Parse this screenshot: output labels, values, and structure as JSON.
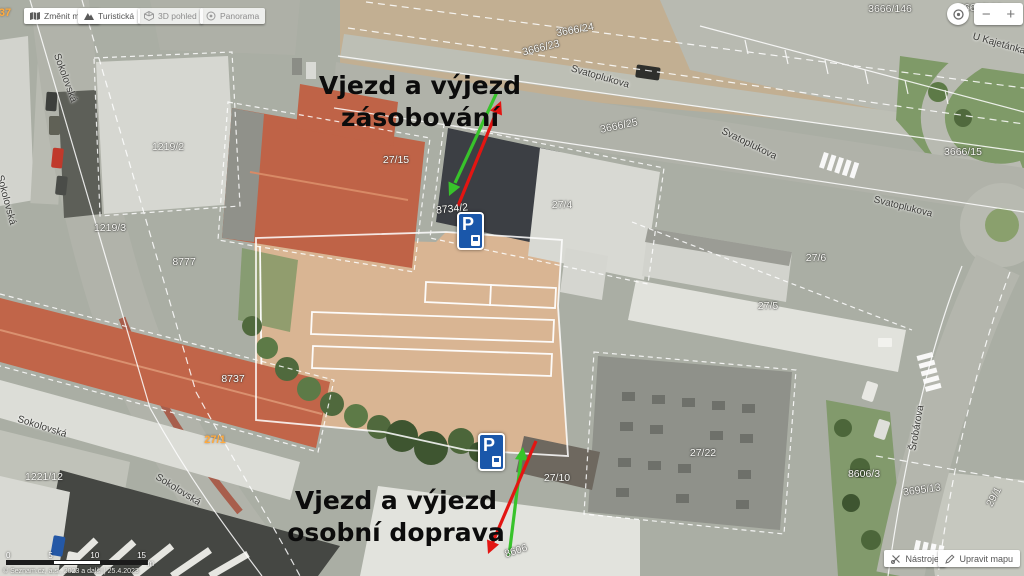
{
  "app": {
    "toolbar": [
      {
        "label": "Změnit mapu"
      },
      {
        "label": "Turistická"
      },
      {
        "label": "3D pohled"
      },
      {
        "label": "Panorama"
      }
    ],
    "map_controls": {
      "zoom_out": "−",
      "zoom_in": "+"
    },
    "footer_tools": [
      {
        "label": "Nástroje"
      },
      {
        "label": "Upravit mapu"
      }
    ],
    "scale_bar": {
      "ticks": [
        "0",
        "5",
        "10",
        "15"
      ],
      "unit": "m"
    },
    "attribution": "© Seznam.cz, a.s., 2023 a další | 25.4.2023"
  },
  "annotations": {
    "supply": {
      "line1": "Vjezd a výjezd",
      "line2": "zásobování"
    },
    "personal": {
      "line1": "Vjezd a výjezd",
      "line2": "osobní doprava"
    },
    "arrow_green": "#38c32b",
    "arrow_red": "#e31512"
  },
  "map": {
    "parking_sign": {
      "letter": "P"
    },
    "labels": [
      {
        "t": "3666/24",
        "x": 575,
        "y": 30,
        "r": -10,
        "c": "parcel"
      },
      {
        "t": "3666/23",
        "x": 541,
        "y": 48,
        "r": -14,
        "c": "parcel"
      },
      {
        "t": "3666/25",
        "x": 619,
        "y": 126,
        "r": -12,
        "c": "parcel"
      },
      {
        "t": "3666/146",
        "x": 890,
        "y": 9,
        "r": 0,
        "c": "parcel"
      },
      {
        "t": "3666/162",
        "x": 980,
        "y": 8,
        "r": 0,
        "c": "parcel"
      },
      {
        "t": "3666/15",
        "x": 963,
        "y": 152,
        "r": 0,
        "c": "parcel"
      },
      {
        "t": "1219/2",
        "x": 168,
        "y": 147,
        "r": 0,
        "c": "parcel"
      },
      {
        "t": "1219/3",
        "x": 110,
        "y": 228,
        "r": 0,
        "c": "parcel"
      },
      {
        "t": "8777",
        "x": 184,
        "y": 262,
        "r": 0,
        "c": "parcel"
      },
      {
        "t": "8737",
        "x": 233,
        "y": 379,
        "r": 0,
        "c": "parcel"
      },
      {
        "t": "8734/2",
        "x": 452,
        "y": 209,
        "r": -6,
        "c": "parcel"
      },
      {
        "t": "27/15",
        "x": 396,
        "y": 160,
        "r": 0,
        "c": "parcel"
      },
      {
        "t": "27/4",
        "x": 562,
        "y": 205,
        "r": 0,
        "c": "parcel"
      },
      {
        "t": "27/6",
        "x": 816,
        "y": 258,
        "r": 0,
        "c": "parcel"
      },
      {
        "t": "27/5",
        "x": 768,
        "y": 306,
        "r": 0,
        "c": "parcel"
      },
      {
        "t": "27/22",
        "x": 703,
        "y": 453,
        "r": 0,
        "c": "parcel"
      },
      {
        "t": "27/10",
        "x": 557,
        "y": 478,
        "r": 0,
        "c": "parcel"
      },
      {
        "t": "3695/13",
        "x": 922,
        "y": 490,
        "r": -8,
        "c": "parcel"
      },
      {
        "t": "8606/3",
        "x": 864,
        "y": 474,
        "r": 0,
        "c": "parcel"
      },
      {
        "t": "8606",
        "x": 516,
        "y": 551,
        "r": -18,
        "c": "parcel"
      },
      {
        "t": "29/1",
        "x": 994,
        "y": 497,
        "r": -62,
        "c": "parcel"
      },
      {
        "t": "1221/12",
        "x": 44,
        "y": 477,
        "r": 0,
        "c": "parcel"
      },
      {
        "t": "27/1",
        "x": 215,
        "y": 440,
        "r": 0,
        "c": "house"
      },
      {
        "t": "37",
        "x": 5,
        "y": 13,
        "r": 0,
        "c": "house"
      },
      {
        "t": "Svatoplukova",
        "x": 600,
        "y": 77,
        "r": 16,
        "c": "street"
      },
      {
        "t": "Svatoplukova",
        "x": 749,
        "y": 144,
        "r": 26,
        "c": "street"
      },
      {
        "t": "Svatoplukova",
        "x": 903,
        "y": 207,
        "r": 14,
        "c": "street"
      },
      {
        "t": "U Kajetánka",
        "x": 999,
        "y": 44,
        "r": 16,
        "c": "street"
      },
      {
        "t": "Sokolovská",
        "x": 65,
        "y": 78,
        "r": 70,
        "c": "street"
      },
      {
        "t": "Sokolovská",
        "x": 6,
        "y": 200,
        "r": 75,
        "c": "street"
      },
      {
        "t": "Sokolovská",
        "x": 42,
        "y": 427,
        "r": 18,
        "c": "street"
      },
      {
        "t": "Sokolovská",
        "x": 178,
        "y": 490,
        "r": 32,
        "c": "street"
      },
      {
        "t": "Šrobárova",
        "x": 917,
        "y": 428,
        "r": -80,
        "c": "street"
      }
    ]
  }
}
